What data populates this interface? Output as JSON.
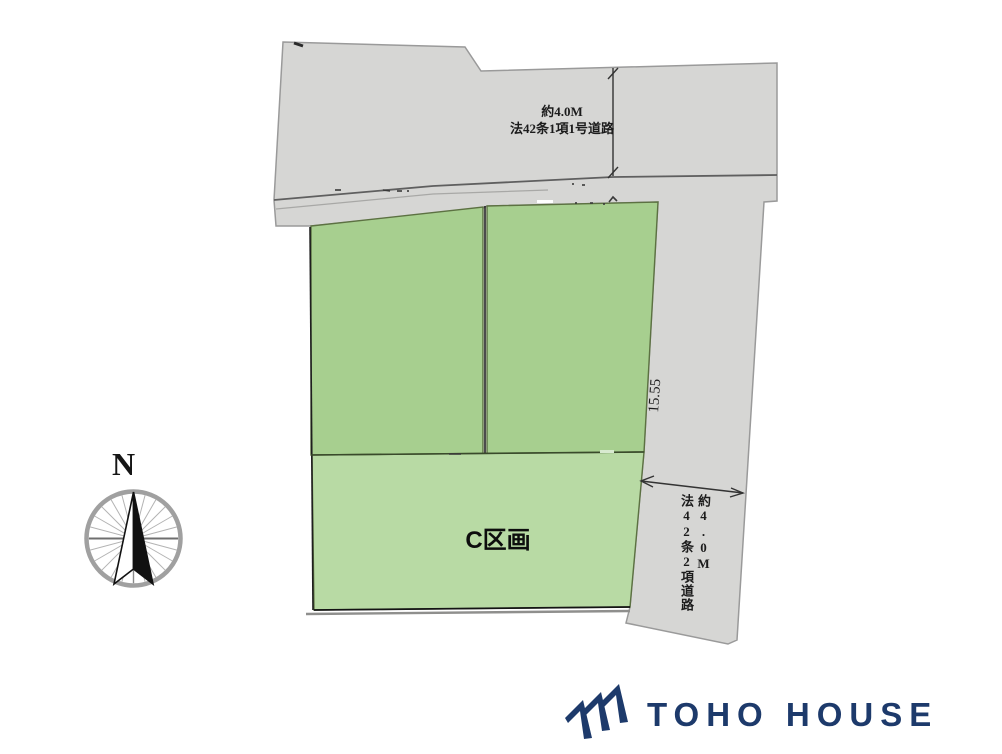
{
  "site_plan": {
    "road_top": {
      "width_label": "約4.0M",
      "name_label": "法42条1項1号道路"
    },
    "road_right": {
      "width_label": "約4.0M",
      "name_label": "法42条2項道路"
    },
    "plots": {
      "c_label": "C区画",
      "right_side_dimension": "15.55"
    }
  },
  "compass": {
    "north_label": "N"
  },
  "branding": {
    "logo_text": "TOHO HOUSE"
  },
  "colors": {
    "road_fill": "#d6d6d4",
    "road_outline": "#9a9a9a",
    "road_line": "#5f5f5f",
    "plot_fill": "#a7cf8f",
    "plot_c_fill": "#b8daa4",
    "plot_border": "#5c7142",
    "ink": "#2a2a2a",
    "logo_navy": "#1d3a6b",
    "compass_ring": "#a0a0a0"
  }
}
